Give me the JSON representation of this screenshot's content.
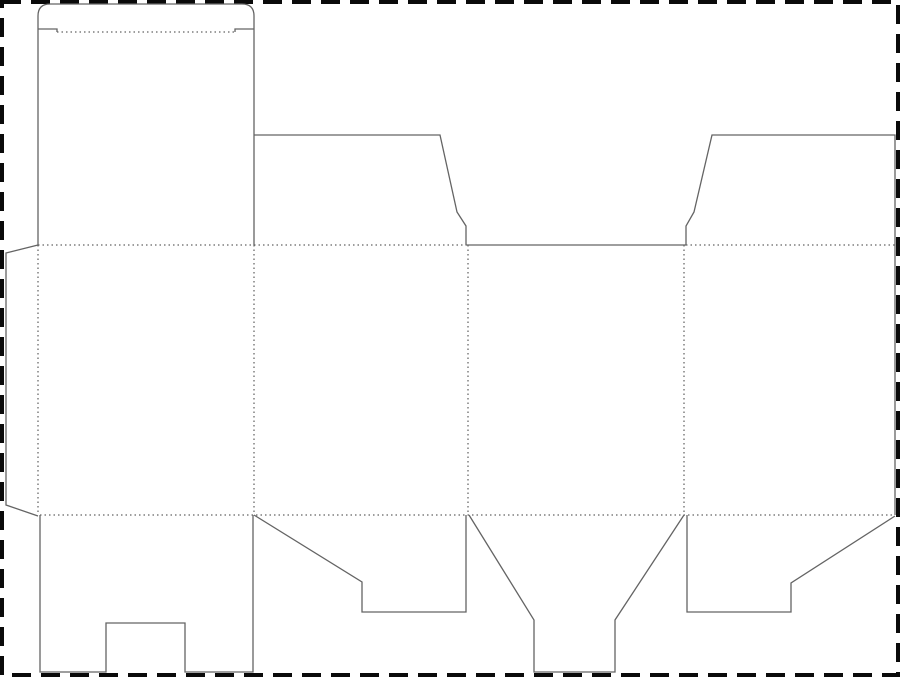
{
  "document": {
    "kind": "packaging-dieline-template",
    "description": "Flat die-cut template (dieline) for a folding carton: four body panels, top tuck flap with rounded corners, two top dust flaps, side glue flap, and four bottom closure flaps, inside a dashed sheet boundary."
  },
  "canvas": {
    "width": 900,
    "height": 677,
    "background": "#ffffff"
  },
  "sheet_border": {
    "style": "dashed",
    "color": "#0a0a0a",
    "thickness": 4,
    "dash": [
      19,
      10
    ],
    "inset": 2
  },
  "line_styles": {
    "cut": {
      "color": "#646464",
      "width": 1.3,
      "dash": null
    },
    "fold": {
      "color": "#3c3c3c",
      "width": 1,
      "dash": [
        1.5,
        3
      ]
    }
  },
  "dieline": {
    "cut_paths": [
      {
        "name": "top-tuck-panel-outline",
        "d": "M 38 245 L 38 16 Q 38 4 50 4 L 242 4 Q 254 4 254 16 L 254 245"
      },
      {
        "name": "tuck-shoulder-slit-left",
        "d": "M 38 29 L 57 29 L 57 32"
      },
      {
        "name": "tuck-shoulder-slit-right",
        "d": "M 254 29 L 235 29 L 235 32"
      },
      {
        "name": "dust-flap-left",
        "d": "M 254 135 L 440 135 L 457 212 L 466 226 L 466 245"
      },
      {
        "name": "panel-3-top-edge",
        "d": "M 466 245 L 686 245"
      },
      {
        "name": "dust-flap-right",
        "d": "M 686 245 L 686 226 L 694 212 L 712 135 L 895 135 L 895 515"
      },
      {
        "name": "glue-flap-outline",
        "d": "M 38 245 L 6 253 L 6 505 L 38 516"
      },
      {
        "name": "bottom-flap-1-notched",
        "d": "M 40 515 L 40 672 L 106 672 L 106 623 L 185 623 L 185 672 L 253 672 L 253 515"
      },
      {
        "name": "bottom-flap-2",
        "d": "M 254 515 L 362 582 L 362 612 L 466 612 L 466 515"
      },
      {
        "name": "bottom-flap-3-funnel",
        "d": "M 469 515 L 534 620 L 534 672 L 615 672 L 615 620 L 684 515"
      },
      {
        "name": "bottom-flap-4",
        "d": "M 687 515 L 687 612 L 791 612 L 791 583 L 895 516"
      }
    ],
    "fold_lines": [
      {
        "name": "tuck-flap-fold",
        "x1": 57,
        "y1": 32,
        "x2": 235,
        "y2": 32
      },
      {
        "name": "top-fold-left-section",
        "x1": 38,
        "y1": 245,
        "x2": 466,
        "y2": 245
      },
      {
        "name": "top-fold-right-section",
        "x1": 686,
        "y1": 245,
        "x2": 895,
        "y2": 245
      },
      {
        "name": "bottom-fold",
        "x1": 40,
        "y1": 515,
        "x2": 895,
        "y2": 515
      },
      {
        "name": "glue-flap-fold",
        "x1": 38,
        "y1": 245,
        "x2": 38,
        "y2": 515
      },
      {
        "name": "fold-panel-1-2",
        "x1": 254,
        "y1": 245,
        "x2": 254,
        "y2": 515
      },
      {
        "name": "fold-panel-2-3",
        "x1": 468,
        "y1": 245,
        "x2": 468,
        "y2": 515
      },
      {
        "name": "fold-panel-3-4",
        "x1": 684,
        "y1": 245,
        "x2": 684,
        "y2": 515
      }
    ]
  }
}
